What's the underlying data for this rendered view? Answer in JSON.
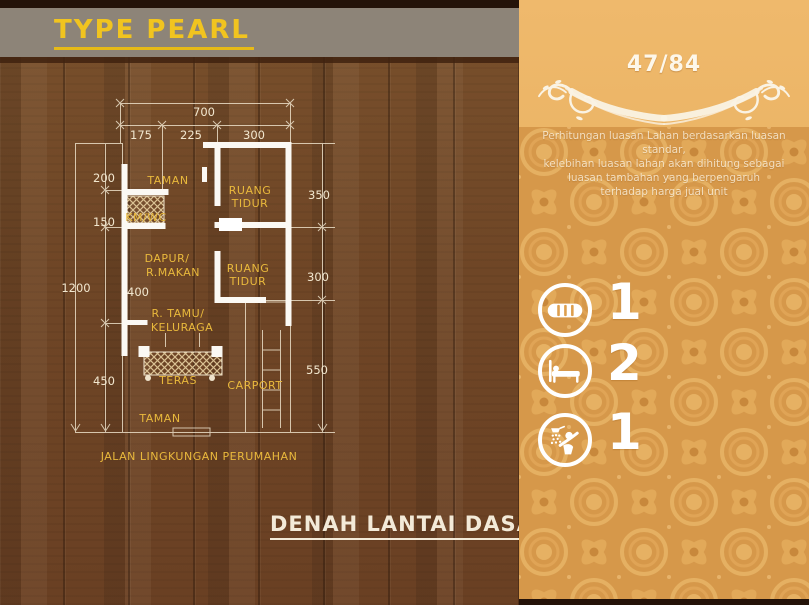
{
  "header": {
    "title": "TYPE PEARL"
  },
  "caption": {
    "text": "DENAH LANTAI DASAR"
  },
  "floorplan": {
    "dimensions": {
      "top_total": "700",
      "top_left": "175",
      "top_mid": "225",
      "top_right": "300",
      "left_total": "1200",
      "left_1": "200",
      "left_2": "150",
      "left_3": "400",
      "left_4": "450",
      "right_1": "350",
      "right_2": "300",
      "right_3": "550"
    },
    "rooms": {
      "garden_front": "TAMAN",
      "bathroom": "KM/WC",
      "bedroom1_line1": "RUANG",
      "bedroom1_line2": "TIDUR",
      "kitchen_line1": "DAPUR/",
      "kitchen_line2": "R.MAKAN",
      "bedroom2_line1": "RUANG",
      "bedroom2_line2": "TIDUR",
      "living_line1": "R. TAMU/",
      "living_line2": "KELURAGA",
      "terrace": "TERAS",
      "carport": "CARPORT",
      "garden_back": "TAMAN"
    },
    "street": "JALAN LINGKUNGAN PERUMAHAN"
  },
  "panel": {
    "lot_size": "47/84",
    "description_lines": [
      "Perhitungan luasan Lahan berdasarkan luasan standar,",
      "kelebihan luasan lahan akan dihitung sebagai",
      "luasan tambahan yang berpengaruh",
      "terhadap harga jual unit"
    ],
    "features": [
      {
        "icon": "car-icon",
        "count": "1"
      },
      {
        "icon": "bed-icon",
        "count": "2"
      },
      {
        "icon": "shower-icon",
        "count": "1"
      }
    ]
  },
  "colors": {
    "accent_gold": "#f1c41f",
    "plan_gold": "#e9b93c",
    "plan_cream": "#f2e7cf",
    "banner_gray": "#8d8478",
    "panel_orange": "#e7af5e",
    "batik_base": "#d6984a",
    "wood_brown": "#6f4626"
  }
}
